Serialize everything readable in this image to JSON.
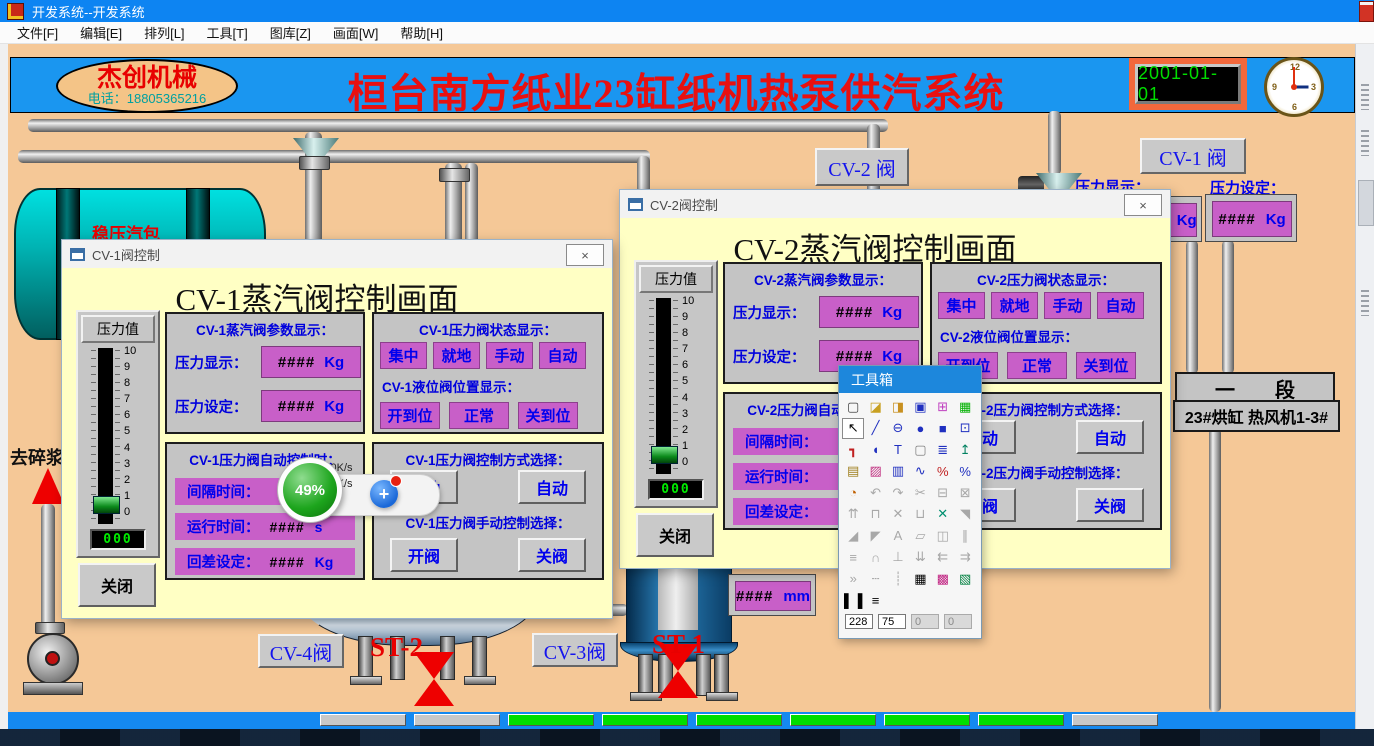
{
  "window": {
    "title": "开发系统--开发系统",
    "minimize": "—",
    "close": "×",
    "dialog_close": "×"
  },
  "menubar": {
    "items": [
      "文件[F]",
      "编辑[E]",
      "排列[L]",
      "工具[T]",
      "图库[Z]",
      "画面[W]",
      "帮助[H]"
    ]
  },
  "header": {
    "logo_title": "杰创机械",
    "logo_phone": "电话：18805365216",
    "title": "桓台南方纸业23缸纸机热泵供汽系统",
    "date": "2001-01-01",
    "clock_numbers": [
      "12",
      "3",
      "6",
      "9"
    ]
  },
  "plant": {
    "tank_label": "稳压汽包",
    "to_pulper_label": "去碎浆",
    "cv1_valve": "CV-1 阀",
    "cv2_valve": "CV-2 阀",
    "cv3_valve": "CV-3阀",
    "cv4_valve": "CV-4阀",
    "st1_label": "ST-1",
    "st2_label": "ST-2",
    "pressure_display_label": "压力显示：",
    "pressure_set_label": "压力设定：",
    "kg_value": "####",
    "kg_unit": "Kg",
    "mm_value": "####",
    "mm_unit": "mm",
    "section_label": "一　　段",
    "dryer_label": "23#烘缸 热风机1-3#"
  },
  "gauge": {
    "label": "压力值",
    "numbers": [
      "10",
      "9",
      "8",
      "7",
      "6",
      "5",
      "4",
      "3",
      "2",
      "1",
      "0"
    ],
    "value": "000"
  },
  "dialogs": {
    "cv1": {
      "title": "CV-1阀控制",
      "heading": "CV-1蒸汽阀控制画面",
      "param": {
        "title": "CV-1蒸汽阀参数显示：",
        "rows": [
          {
            "label": "压力显示：",
            "value": "####",
            "unit": "Kg"
          },
          {
            "label": "压力设定：",
            "value": "####",
            "unit": "Kg"
          }
        ]
      },
      "status": {
        "title": "CV-1压力阀状态显示：",
        "chips": [
          "集中",
          "就地",
          "手动",
          "自动"
        ],
        "subtitle": "CV-1液位阀位置显示：",
        "chips2": [
          "开到位",
          "正常",
          "关到位"
        ]
      },
      "auto": {
        "title": "CV-1压力阀自动控制时：",
        "rows": [
          {
            "label": "间隔时间：",
            "value": "",
            "unit": ""
          },
          {
            "label": "运行时间：",
            "value": "####",
            "unit": "s"
          },
          {
            "label": "回差设定：",
            "value": "####",
            "unit": "Kg"
          }
        ]
      },
      "mode": {
        "title": "CV-1压力阀控制方式选择：",
        "buttons": [
          "手动",
          "自动"
        ],
        "subtitle": "CV-1压力阀手动控制选择：",
        "buttons2": [
          "开阀",
          "关阀"
        ]
      },
      "close_label": "关闭"
    },
    "cv2": {
      "title": "CV-2阀控制",
      "heading": "CV-2蒸汽阀控制画面",
      "param": {
        "title": "CV-2蒸汽阀参数显示：",
        "rows": [
          {
            "label": "压力显示：",
            "value": "####",
            "unit": "Kg"
          },
          {
            "label": "压力设定：",
            "value": "####",
            "unit": "Kg"
          }
        ]
      },
      "status": {
        "title": "CV-2压力阀状态显示：",
        "chips": [
          "集中",
          "就地",
          "手动",
          "自动"
        ],
        "subtitle": "CV-2液位阀位置显示：",
        "chips2": [
          "开到位",
          "正常",
          "关到位"
        ]
      },
      "auto": {
        "title": "CV-2压力阀自动控制时：",
        "rows": [
          {
            "label": "间隔时间：",
            "value": "",
            "unit": ""
          },
          {
            "label": "运行时间：",
            "value": "",
            "unit": ""
          },
          {
            "label": "回差设定：",
            "value": "",
            "unit": ""
          }
        ]
      },
      "mode": {
        "title": "CV-2压力阀控制方式选择：",
        "buttons": [
          "手动",
          "自动"
        ],
        "subtitle": "CV-2压力阀手动控制选择：",
        "buttons2": [
          "开阀",
          "关阀"
        ]
      },
      "close_label": "关闭"
    }
  },
  "toolbox": {
    "title": "工具箱",
    "icons": [
      {
        "n": "new-icon",
        "g": "▢",
        "c": "#404040"
      },
      {
        "n": "open-icon",
        "g": "◪",
        "c": "#c8a020"
      },
      {
        "n": "exit-icon",
        "g": "◨",
        "c": "#c89020"
      },
      {
        "n": "save-icon",
        "g": "▣",
        "c": "#2030c0"
      },
      {
        "n": "capture-icon",
        "g": "⊞",
        "c": "#c040c0"
      },
      {
        "n": "display-icon",
        "g": "▦",
        "c": "#00b000"
      },
      {
        "n": "pointer-icon",
        "g": "↖",
        "c": "#000000",
        "sel": true
      },
      {
        "n": "line-icon",
        "g": "╱",
        "c": "#2030c0"
      },
      {
        "n": "ellipse-icon",
        "g": "⊖",
        "c": "#2030c0"
      },
      {
        "n": "circle-icon",
        "g": "●",
        "c": "#2030c0"
      },
      {
        "n": "rect-icon",
        "g": "■",
        "c": "#2030c0"
      },
      {
        "n": "polyline-icon",
        "g": "⊡",
        "c": "#2030c0"
      },
      {
        "n": "pipe-icon",
        "g": "┓",
        "c": "#c02020"
      },
      {
        "n": "arc-icon",
        "g": "◖",
        "c": "#2030c0"
      },
      {
        "n": "text-icon",
        "g": "T",
        "c": "#2030c0"
      },
      {
        "n": "button-icon",
        "g": "▢",
        "c": "#808080"
      },
      {
        "n": "report-icon",
        "g": "≣",
        "c": "#2030c0"
      },
      {
        "n": "rocket-icon",
        "g": "↥",
        "c": "#008060"
      },
      {
        "n": "script-icon",
        "g": "▤",
        "c": "#a08020"
      },
      {
        "n": "image-icon",
        "g": "▨",
        "c": "#c03080"
      },
      {
        "n": "chart-icon",
        "g": "▥",
        "c": "#2030c0"
      },
      {
        "n": "trend-icon",
        "g": "∿",
        "c": "#2030c0"
      },
      {
        "n": "tag-red-icon",
        "g": "%",
        "c": "#c02020"
      },
      {
        "n": "tag-blue-icon",
        "g": "%",
        "c": "#2030c0"
      },
      {
        "n": "animate-icon",
        "g": "◔",
        "c": "#c06000"
      },
      {
        "n": "undo-icon",
        "g": "↶"
      },
      {
        "n": "redo-icon",
        "g": "↷"
      },
      {
        "n": "cut-icon",
        "g": "✂"
      },
      {
        "n": "copy-icon",
        "g": "⊟"
      },
      {
        "n": "paste-icon",
        "g": "⊠"
      },
      {
        "n": "group-icon",
        "g": "⇈"
      },
      {
        "n": "to-top-icon",
        "g": "⊓"
      },
      {
        "n": "ungroup-icon",
        "g": "✕"
      },
      {
        "n": "to-bottom-icon",
        "g": "⊔"
      },
      {
        "n": "swap-icon",
        "g": "✕",
        "c": "#009070"
      },
      {
        "n": "corner-icon",
        "g": "◥"
      },
      {
        "n": "rotate-left-icon",
        "g": "◢"
      },
      {
        "n": "rotate-right-icon",
        "g": "◤"
      },
      {
        "n": "font-icon",
        "g": "A"
      },
      {
        "n": "style-copy-icon",
        "g": "▱"
      },
      {
        "n": "flip-icon",
        "g": "◫"
      },
      {
        "n": "mirror-icon",
        "g": "∥"
      },
      {
        "n": "align-bottom-icon",
        "g": "≡"
      },
      {
        "n": "align-top-icon",
        "g": "∩"
      },
      {
        "n": "align-center-icon",
        "g": "⊥"
      },
      {
        "n": "distribute-icon",
        "g": "⇊"
      },
      {
        "n": "align-left-icon",
        "g": "⇇"
      },
      {
        "n": "align-right-icon",
        "g": "⇉"
      },
      {
        "n": "send-icon",
        "g": "»"
      },
      {
        "n": "hdots-icon",
        "g": "┄"
      },
      {
        "n": "vdots-icon",
        "g": "┊"
      },
      {
        "n": "grid-icon",
        "g": "▦",
        "c": "#000000"
      },
      {
        "n": "palette-icon",
        "g": "▩",
        "c": "#c02080"
      },
      {
        "n": "node-select-icon",
        "g": "▧",
        "c": "#008040"
      },
      {
        "n": "fill-style-icon",
        "g": "▌▐",
        "c": "#000000"
      },
      {
        "n": "line-style-icon",
        "g": "≡",
        "c": "#000000"
      }
    ],
    "fields": [
      {
        "v": "228"
      },
      {
        "v": "75"
      },
      {
        "v": "0",
        "dis": true
      },
      {
        "v": "0",
        "dis": true
      }
    ]
  },
  "overlay": {
    "percent": "49%",
    "up_arrow": "↑",
    "up_speed": "0K/s",
    "down_arrow": "↓",
    "down_speed": "0K/s",
    "plus": "+"
  },
  "statusbar": {
    "boxes": [
      {
        "bg": "#c8c8c8"
      },
      {
        "bg": "#c8c8c8"
      },
      {
        "bg": "#00dd00"
      },
      {
        "bg": "#00dd00"
      },
      {
        "bg": "#00dd00"
      },
      {
        "bg": "#00dd00"
      },
      {
        "bg": "#00dd00"
      },
      {
        "bg": "#00dd00"
      },
      {
        "bg": "#c8c8c8"
      }
    ]
  },
  "colors": {
    "header_blue": "#1a96f0",
    "canvas_peach": "#f5c897",
    "dialog_yellow": "#ffffc4",
    "magenta": "#c85fc8",
    "toolbox_blue": "#1d87dc",
    "title_red": "#e81010",
    "digit_green": "#00dd00"
  }
}
